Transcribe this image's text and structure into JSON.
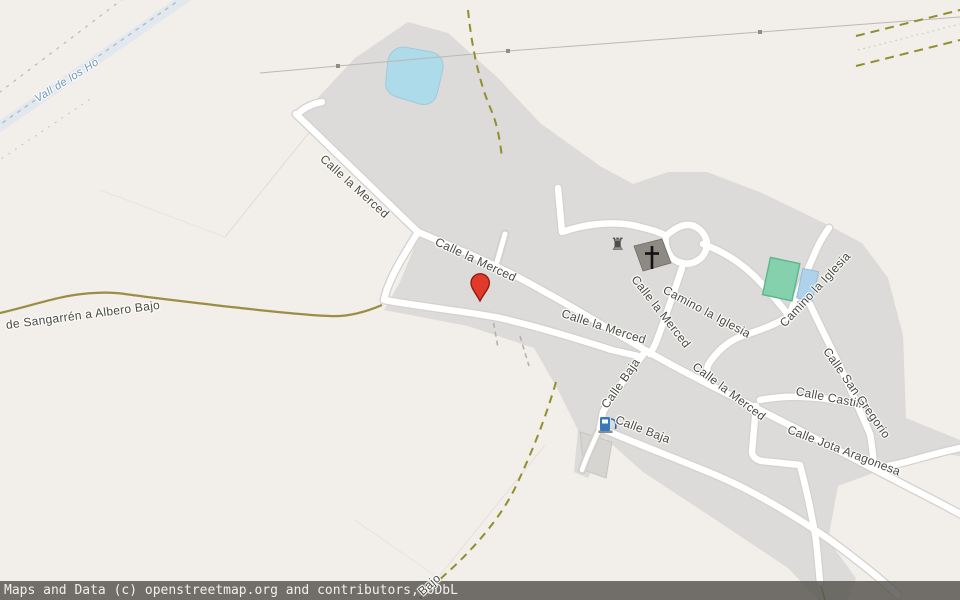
{
  "map": {
    "type": "openstreetmap-static",
    "attribution": "Maps and Data (c) openstreetmap.org and contributors, ODbL",
    "marker": {
      "label": "selected-location",
      "color": "#e23a2a"
    },
    "colors": {
      "background": "#f2eee9",
      "residential_area": "#dcdbd9",
      "road_fill": "#ffffff",
      "road_casing": "#d2d1ce",
      "water": "#aedbe9",
      "sports_pitch": "#85d1ad",
      "swimming_pool": "#aed2ea",
      "track_dashed": "#8f8f2e",
      "unpaved_road": "#9b8d42",
      "marker_red": "#e23a2a",
      "fuel_blue": "#3779bd",
      "attribution_bg": "#54524d"
    },
    "poi": [
      {
        "name": "church",
        "icon": "christian-cross"
      },
      {
        "name": "ruins",
        "icon": "castle-ruins"
      },
      {
        "name": "fuel-station",
        "icon": "fuel-pump"
      }
    ],
    "street_labels": [
      {
        "text": "Vall de los Ho",
        "x": 36,
        "y": 94,
        "rot": -32,
        "style": "water-label"
      },
      {
        "text": "de Sangarrén a Albero Bajo",
        "x": 6,
        "y": 318,
        "rot": -7.5,
        "style": "road-label"
      },
      {
        "text": "Calle la Merced",
        "x": 322,
        "y": 150,
        "rot": 42,
        "style": "road-label"
      },
      {
        "text": "Calle la Merced",
        "x": 436,
        "y": 234,
        "rot": 25,
        "style": "road-label"
      },
      {
        "text": "Calle la Merced",
        "x": 562,
        "y": 306,
        "rot": 18,
        "style": "road-label"
      },
      {
        "text": "Calle la Merced",
        "x": 694,
        "y": 358,
        "rot": 37,
        "style": "road-label"
      },
      {
        "text": "Calle la Merced",
        "x": 634,
        "y": 270,
        "rot": 52,
        "style": "road-label"
      },
      {
        "text": "Camino la Iglesia",
        "x": 664,
        "y": 282,
        "rot": 28,
        "style": "road-label"
      },
      {
        "text": "Camino la Iglesia",
        "x": 782,
        "y": 318,
        "rot": -47,
        "style": "road-label"
      },
      {
        "text": "Calle Baja",
        "x": 604,
        "y": 400,
        "rot": -55,
        "style": "road-label"
      },
      {
        "text": "Calle Baja",
        "x": 616,
        "y": 412,
        "rot": 21,
        "style": "road-label"
      },
      {
        "text": "Calle Castillo",
        "x": 796,
        "y": 384,
        "rot": 11,
        "style": "road-label"
      },
      {
        "text": "Calle San Gregorio",
        "x": 826,
        "y": 342,
        "rot": 55,
        "style": "road-label"
      },
      {
        "text": "Calle Jota Aragonesa",
        "x": 788,
        "y": 422,
        "rot": 21,
        "style": "road-label"
      },
      {
        "text": "Bajo",
        "x": 420,
        "y": 586,
        "rot": -42,
        "style": "road-label"
      }
    ]
  }
}
